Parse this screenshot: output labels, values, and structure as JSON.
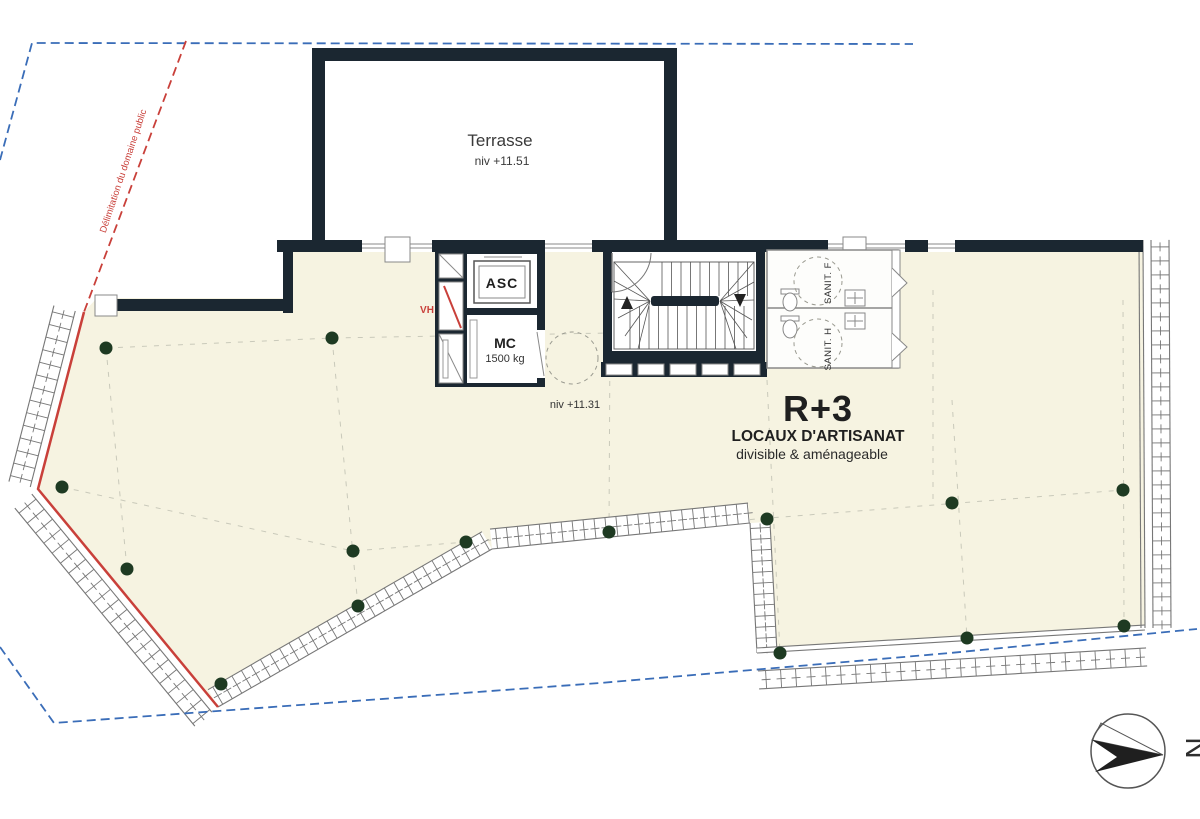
{
  "drawing": {
    "title": "R+3",
    "subtitle": "LOCAUX D'ARTISANAT",
    "note": "divisible & aménageable",
    "terrace": {
      "label": "Terrasse",
      "level": "niv +11.51"
    },
    "level_label": "niv +11.31",
    "elevator_label": "ASC",
    "freight": {
      "label": "MC",
      "capacity": "1500 kg"
    },
    "duct_label": "VH",
    "sanitary": {
      "women": "SANIT. F",
      "men": "SANIT. H"
    },
    "boundary_label": "Délimitation du domaine public",
    "north_label": "N",
    "colors": {
      "wall": "#1b2731",
      "floor": "#f6f3e1",
      "boundary_blue": "#3a6db8",
      "boundary_red": "#c9403a",
      "column_green": "#1e3a22",
      "dim_gray": "#777777"
    },
    "columns": [
      [
        106,
        348
      ],
      [
        332,
        338
      ],
      [
        62,
        487
      ],
      [
        127,
        569
      ],
      [
        221,
        684
      ],
      [
        353,
        551
      ],
      [
        466,
        542
      ],
      [
        609,
        532
      ],
      [
        358,
        606
      ],
      [
        767,
        519
      ],
      [
        952,
        503
      ],
      [
        1123,
        490
      ],
      [
        780,
        653
      ],
      [
        967,
        638
      ],
      [
        1124,
        626
      ]
    ]
  }
}
